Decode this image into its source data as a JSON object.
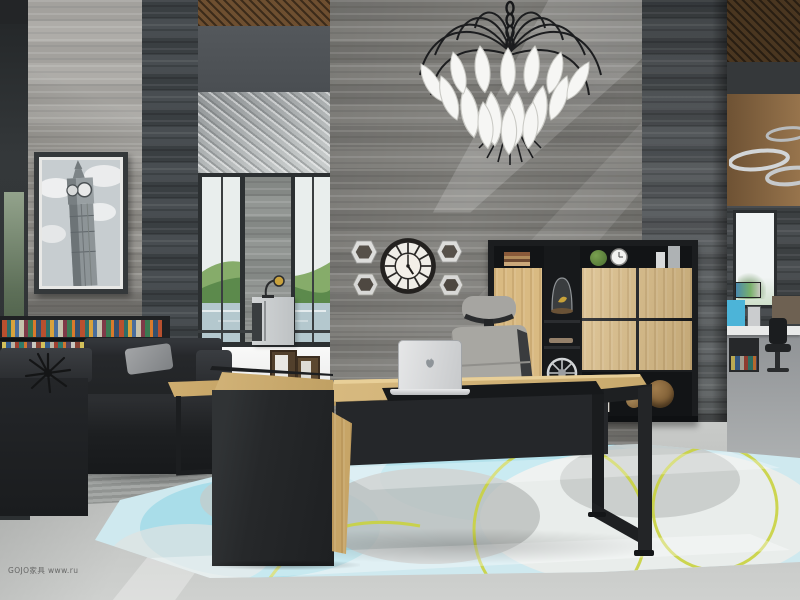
{
  "meta": {
    "type": "photograph",
    "subject": "Modern executive office interior: grey travertine feature wall, white leaf chandelier, oak-and-black executive desk with laptop, storage cabinet, lounge sofas and pale blue area rug"
  },
  "watermark": {
    "text": "GOJO家具 www.ru"
  },
  "wall_clock": {
    "time": "5:00",
    "style": "segmented round face, dark bezel"
  },
  "artwork": {
    "subject": "Big Ben black-and-white photograph in dark frame"
  },
  "laptop": {
    "brand_icon": "apple-logo"
  },
  "view": {
    "outside": "green hills and lake seen through floor-to-ceiling windows"
  },
  "palette": {
    "marble_wall": "#7e7d7a",
    "dark_stone": "#3f4446",
    "oak_wood": "#d9bb84",
    "desk_black": "#26282a",
    "rug_blue": "#cfe9ef",
    "rug_accent_line": "#c9d23f",
    "floor_concrete": "#c6c8c6",
    "chandelier_leaf": "#f6f6f4",
    "hills_green": "#6f9b58",
    "far_panel_blue": "#4cb4d8"
  }
}
